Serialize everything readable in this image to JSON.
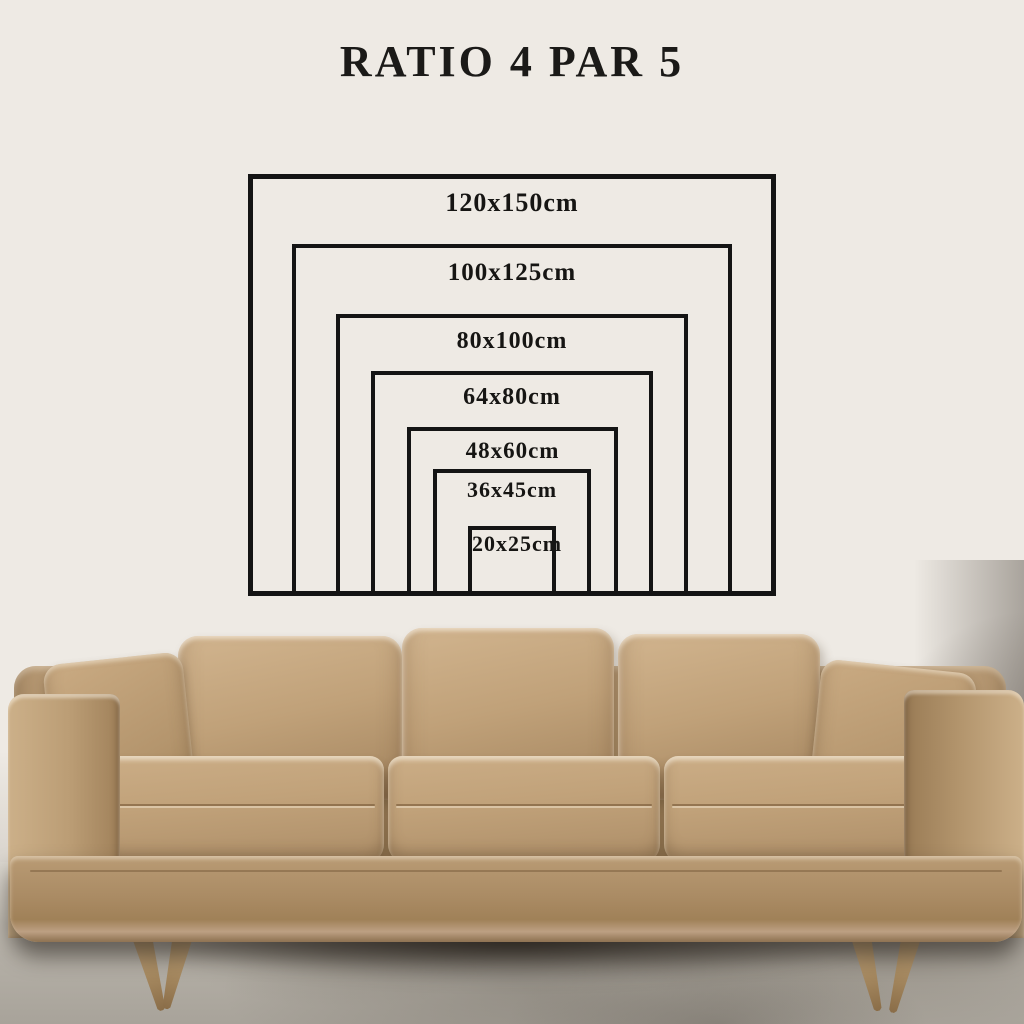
{
  "title": "RATIO 4 PAR 5",
  "diagram": {
    "unit": "cm",
    "aspect_ratio": "4:5",
    "sizes": [
      {
        "label": "120x150cm",
        "height_cm": 120,
        "width_cm": 150
      },
      {
        "label": "100x125cm",
        "height_cm": 100,
        "width_cm": 125
      },
      {
        "label": "80x100cm",
        "height_cm": 80,
        "width_cm": 100
      },
      {
        "label": "64x80cm",
        "height_cm": 64,
        "width_cm": 80
      },
      {
        "label": "48x60cm",
        "height_cm": 48,
        "width_cm": 60
      },
      {
        "label": "36x45cm",
        "height_cm": 36,
        "width_cm": 45
      },
      {
        "label": "20x25cm",
        "height_cm": 20,
        "width_cm": 25
      }
    ]
  },
  "colors": {
    "line": "#141414",
    "text": "#1b1a18",
    "wall": "#eeeae4",
    "leather": "#bfa078",
    "wood": "#a78a61",
    "floor": "#b4afa6"
  }
}
